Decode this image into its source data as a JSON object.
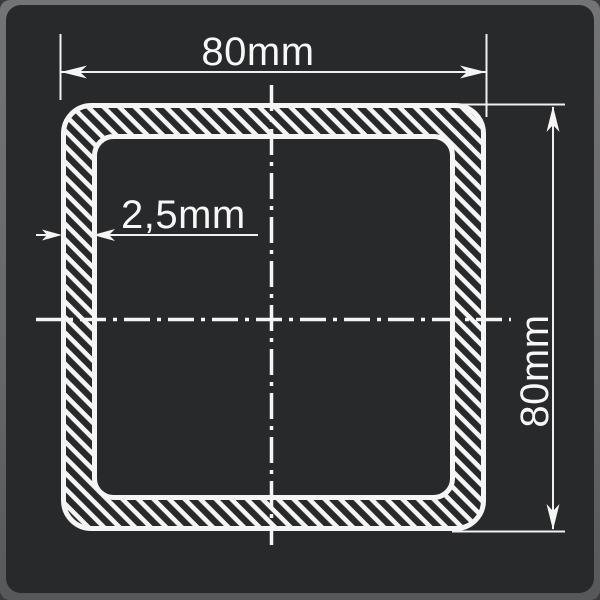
{
  "drawing": {
    "type": "technical-cross-section",
    "subject": "square hollow tube profile with dimension callouts",
    "labels": {
      "width": "80mm",
      "height": "80mm",
      "wall_thickness": "2,5mm"
    },
    "dimensions": {
      "outer_width_mm": 80,
      "outer_height_mm": 80,
      "wall_thickness_mm": 2.5
    },
    "colors": {
      "canvas_background": "#28292b",
      "frame": "#68696b",
      "line": "#f7f7f7"
    },
    "line_styles": {
      "centerline": "dash-dot",
      "outline": "solid",
      "wall_fill": "diagonal-hatch"
    }
  }
}
